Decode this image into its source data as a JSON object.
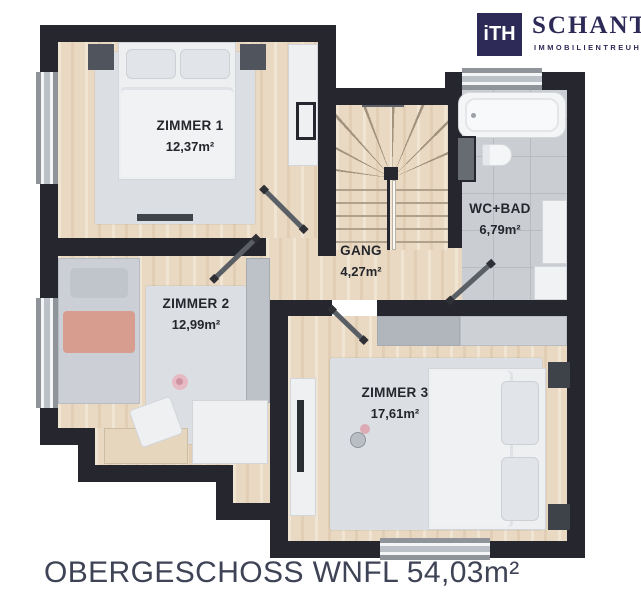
{
  "logo": {
    "monogram": "iTH",
    "company": "SCHANTL",
    "tagline": "IMMOBILIENTREUHAND"
  },
  "plan": {
    "caption": "OBERGESCHOSS WNFL 54,03m²",
    "rooms": [
      {
        "name": "ZIMMER 1",
        "area": "12,37m²"
      },
      {
        "name": "ZIMMER 2",
        "area": "12,99m²"
      },
      {
        "name": "ZIMMER 3",
        "area": "17,61m²"
      },
      {
        "name": "GANG",
        "area": "4,27m²"
      },
      {
        "name": "WC+BAD",
        "area": "6,79m²"
      }
    ]
  },
  "colors": {
    "brand_navy": "#2d2a57",
    "wall": "#26262e",
    "wood_floor": "#ead9c2",
    "tile_floor": "#caced3",
    "rug": "#dbdfe3",
    "caption_text": "#3e4355"
  }
}
